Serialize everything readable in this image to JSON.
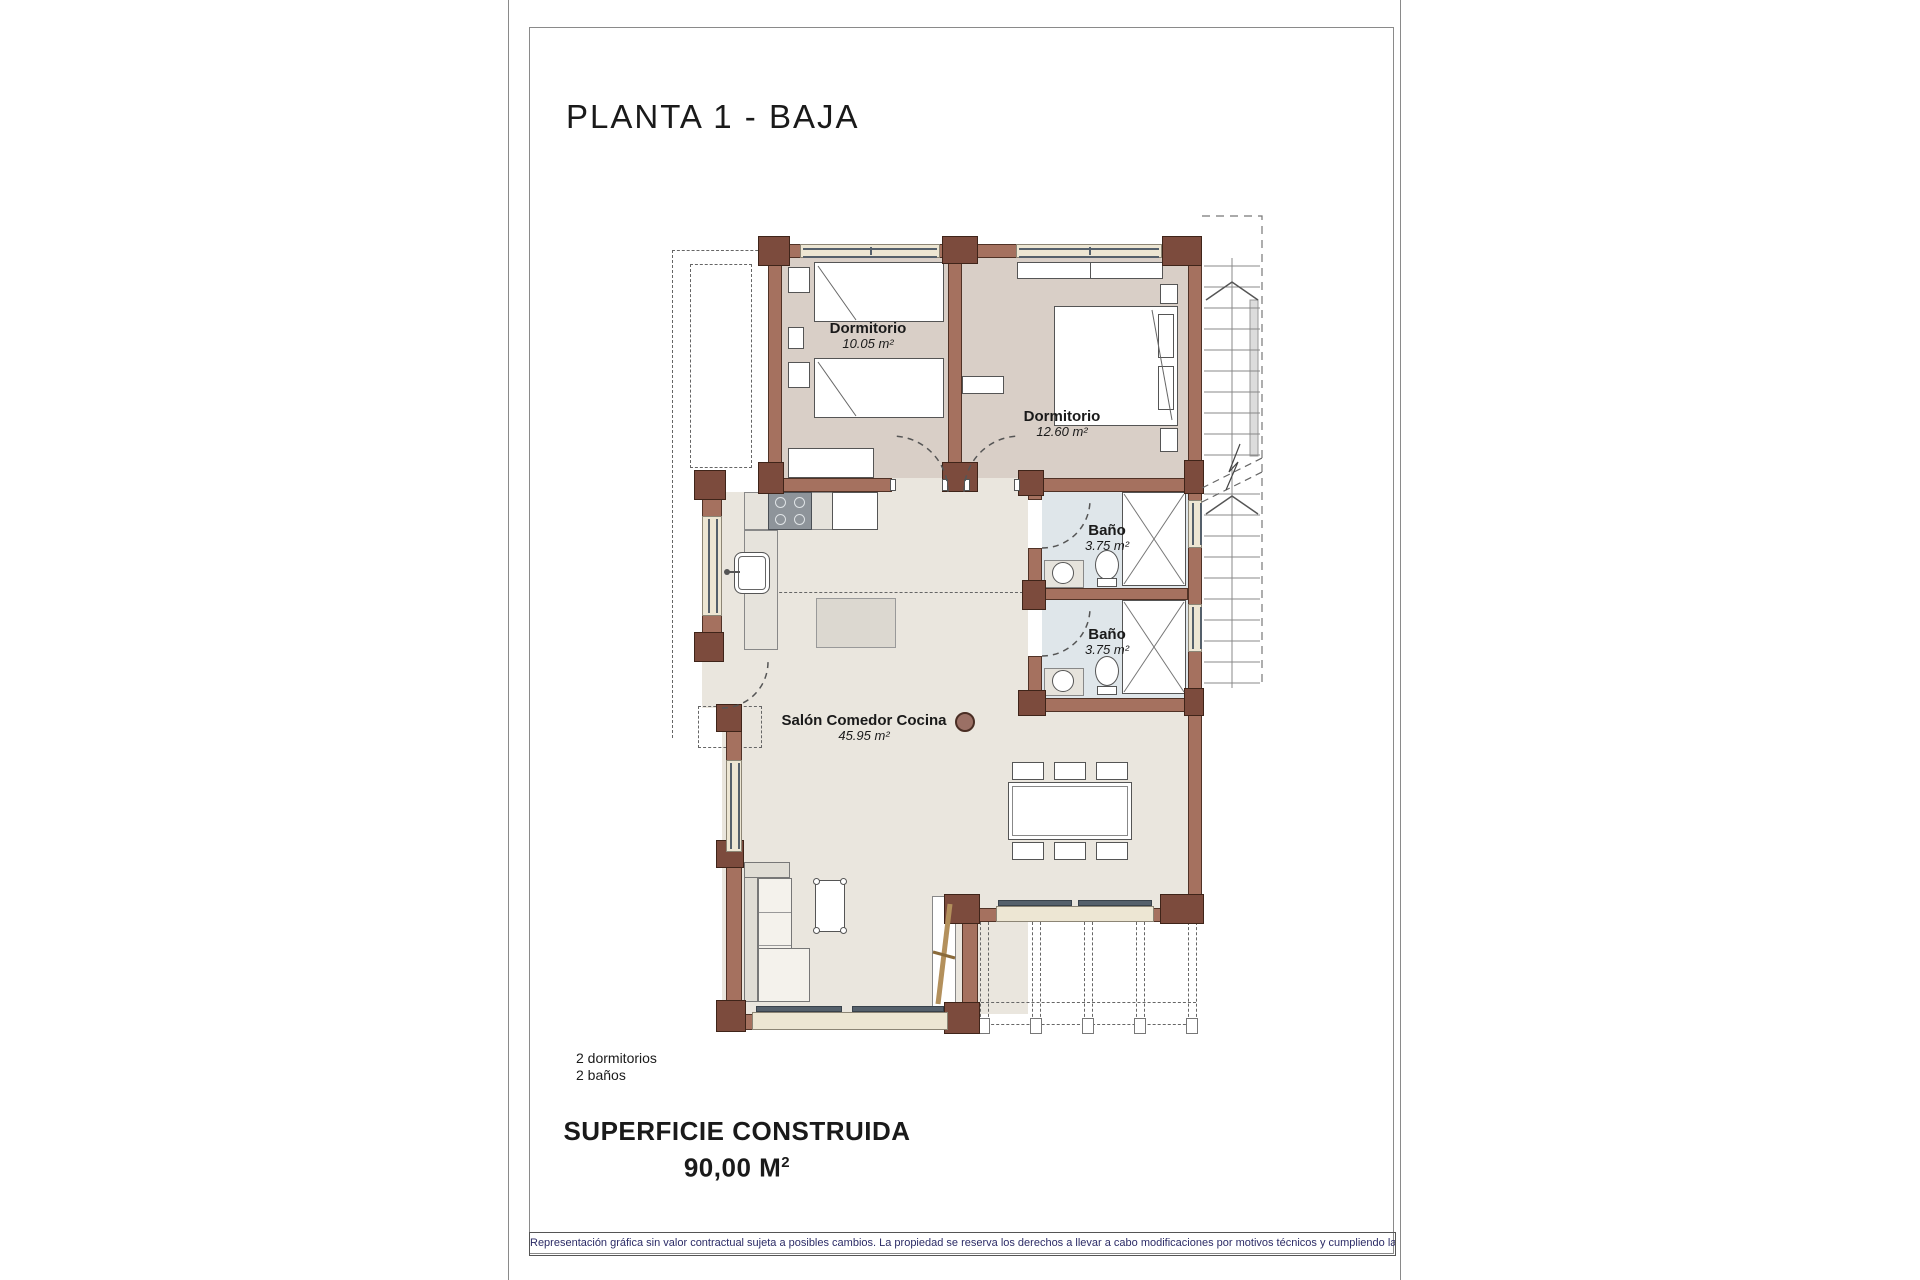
{
  "title": "PLANTA 1 - BAJA",
  "rooms": [
    {
      "id": "bedroom-1",
      "name": "Dormitorio",
      "area": "10.05 m²"
    },
    {
      "id": "bedroom-2",
      "name": "Dormitorio",
      "area": "12.60 m²"
    },
    {
      "id": "bath-1",
      "name": "Baño",
      "area": "3.75 m²"
    },
    {
      "id": "bath-2",
      "name": "Baño",
      "area": "3.75 m²"
    },
    {
      "id": "living",
      "name": "Salón Comedor Cocina",
      "area": "45.95 m²"
    }
  ],
  "summary": {
    "bedrooms": "2 dormitorios",
    "baths": "2 baños"
  },
  "surface": {
    "label": "SUPERFICIE CONSTRUIDA",
    "value": "90,00 M",
    "sup": "2"
  },
  "disclaimer": "Representación gráfica sin valor contractual sujeta a posibles cambios. La propiedad se reserva los derechos a llevar a cabo modificaciones por motivos técnicos y cumpliendo la normativa vigente.",
  "colors": {
    "wall": "#a5715f",
    "wall_dark": "#7c4b3d",
    "floor_bedroom": "#d9cfc7",
    "floor_living": "#eae6de",
    "floor_bath": "#dfe6ea",
    "window_sill": "#ede6d3",
    "glazing": "#55606b",
    "disclaimer_text": "#2b2b66"
  }
}
